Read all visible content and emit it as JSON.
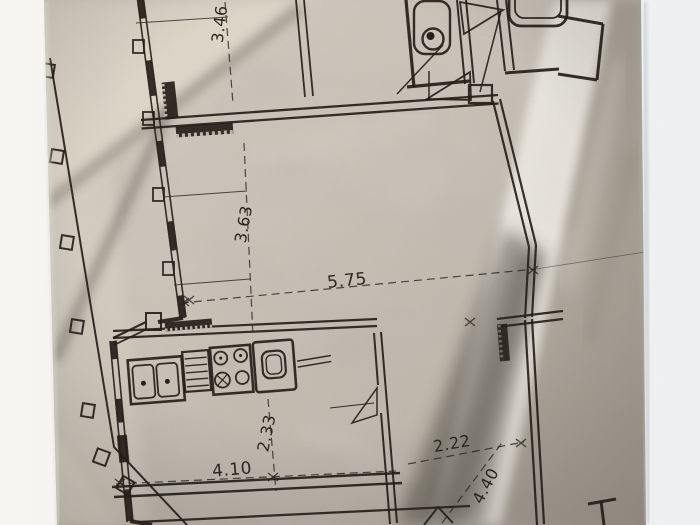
{
  "meta": {
    "description": "Crumpled photocopy of an apartment floor plan"
  },
  "dimensions": [
    {
      "id": "3-46",
      "value": "3.46",
      "orientation": "vertical"
    },
    {
      "id": "3-63",
      "value": "3.63",
      "orientation": "vertical"
    },
    {
      "id": "5-75",
      "value": "5.75",
      "orientation": "horizontal"
    },
    {
      "id": "2-33",
      "value": "2.33",
      "orientation": "vertical"
    },
    {
      "id": "4-10",
      "value": "4.10",
      "orientation": "horizontal"
    },
    {
      "id": "2-22",
      "value": "2.22",
      "orientation": "horizontal"
    },
    {
      "id": "4-40",
      "value": "4.40",
      "orientation": "vertical"
    }
  ],
  "fixtures": [
    {
      "icon": "toilet-icon"
    },
    {
      "icon": "bathtub-icon"
    },
    {
      "icon": "kitchen-sink-icon"
    },
    {
      "icon": "dish-drainer-icon"
    },
    {
      "icon": "stove-icon"
    },
    {
      "icon": "oven-icon"
    },
    {
      "icon": "door-swing-icon"
    }
  ],
  "colors": {
    "ink": "#1f1a14",
    "paper": "#c6c0b4",
    "fold_highlight": "#ebe8e0",
    "fold_shadow": "#2b261f",
    "background_left": "#f6f5f2",
    "background_right": "#edeff1"
  }
}
